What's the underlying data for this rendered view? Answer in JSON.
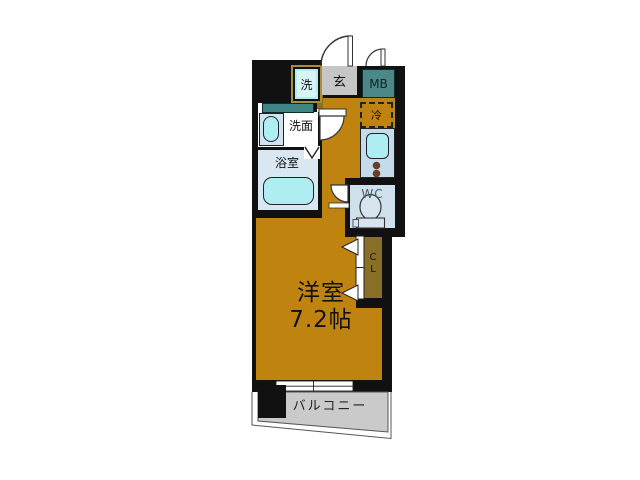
{
  "title": "apartment floor plan",
  "plan": {
    "rooms": {
      "laundry": {
        "label": "洗"
      },
      "entrance": {
        "label": "玄"
      },
      "meter_box": {
        "label": "MB"
      },
      "washroom": {
        "label": "洗面"
      },
      "bathroom": {
        "label": "浴室"
      },
      "refrigerator": {
        "label": "冷"
      },
      "toilet": {
        "label": "WC"
      },
      "closet": {
        "char_top": "C",
        "char_bottom": "L"
      },
      "main_room": {
        "name": "洋室",
        "size": "7.2帖"
      },
      "balcony": {
        "label": "バルコニー"
      }
    },
    "colors": {
      "wall": "#111111",
      "floor": "#bf830f",
      "floor_step": "#8f6f1d",
      "closet": "#8a7026",
      "teal_box": "#4d8888",
      "teal_strip": "#3f8585",
      "gray_entrance": "#c6c6c6",
      "laundry_fill": "#d9f4f4",
      "tub": "#aeeef2",
      "counter": "#c3dbea",
      "bathroom_bg": "#d9e7f2",
      "washroom_sink_bg": "#cfe4f0",
      "wc_bg": "#cfe0ed",
      "toilet_fill": "#d7e3ee",
      "balcony_bg": "#cacaca",
      "burner": "#6e3a22",
      "outline_tan": "#a98c3c"
    }
  }
}
